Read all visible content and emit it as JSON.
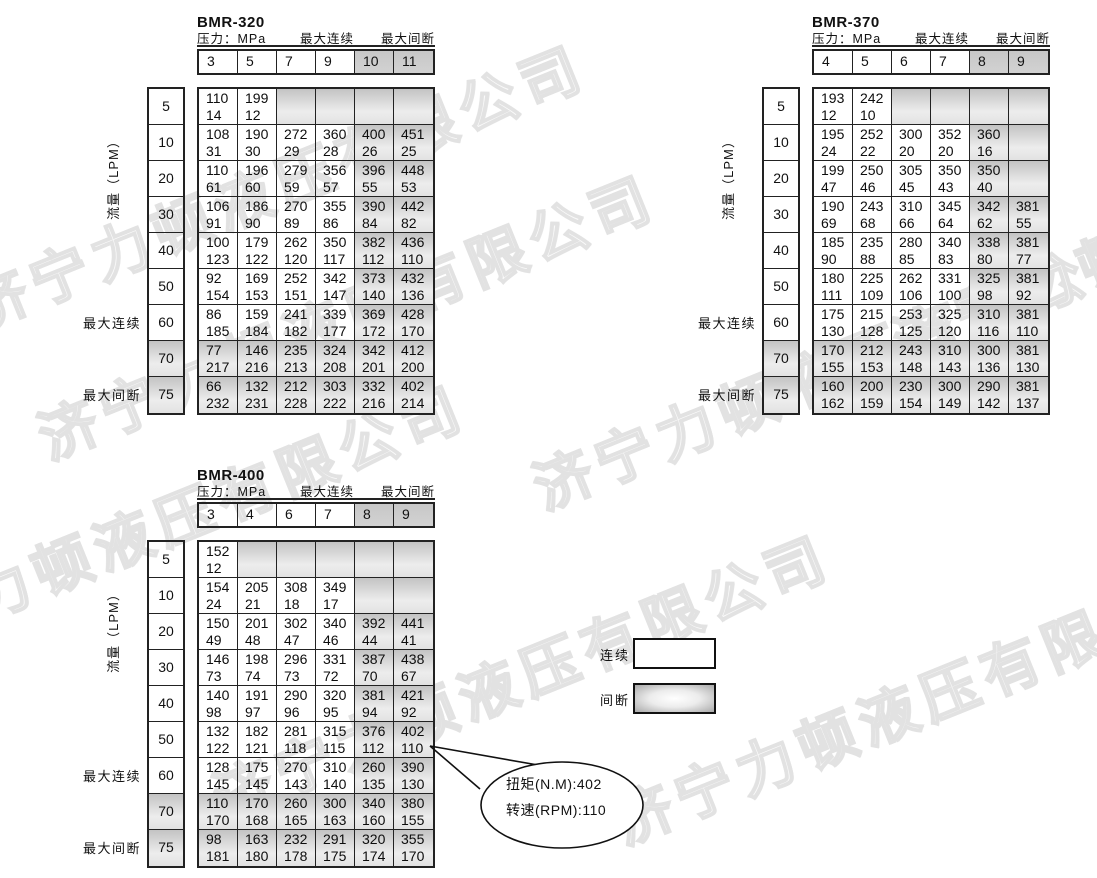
{
  "watermark": {
    "text": "济宁力顿液压有限公司"
  },
  "labels": {
    "pressure": "压力：MPa",
    "max_continuous": "最大连续",
    "max_intermittent": "最大间断",
    "flow": "流量（LPM）"
  },
  "legend": {
    "continuous": "连续",
    "intermittent": "间断"
  },
  "callout": {
    "line1": "扭矩(N.M):402",
    "line2": "转速(RPM):110"
  },
  "tables": [
    {
      "title": "BMR-320",
      "pressures": [
        "3",
        "5",
        "7",
        "9",
        "10",
        "11"
      ],
      "rows": [
        {
          "flow": "5",
          "cells": [
            [
              "110",
              "14"
            ],
            [
              "199",
              "12"
            ],
            null,
            null,
            null,
            null
          ]
        },
        {
          "flow": "10",
          "cells": [
            [
              "108",
              "31"
            ],
            [
              "190",
              "30"
            ],
            [
              "272",
              "29"
            ],
            [
              "360",
              "28"
            ],
            [
              "400",
              "26"
            ],
            [
              "451",
              "25"
            ]
          ]
        },
        {
          "flow": "20",
          "cells": [
            [
              "110",
              "61"
            ],
            [
              "196",
              "60"
            ],
            [
              "279",
              "59"
            ],
            [
              "356",
              "57"
            ],
            [
              "396",
              "55"
            ],
            [
              "448",
              "53"
            ]
          ]
        },
        {
          "flow": "30",
          "cells": [
            [
              "106",
              "91"
            ],
            [
              "186",
              "90"
            ],
            [
              "270",
              "89"
            ],
            [
              "355",
              "86"
            ],
            [
              "390",
              "84"
            ],
            [
              "442",
              "82"
            ]
          ]
        },
        {
          "flow": "40",
          "cells": [
            [
              "100",
              "123"
            ],
            [
              "179",
              "122"
            ],
            [
              "262",
              "120"
            ],
            [
              "350",
              "117"
            ],
            [
              "382",
              "112"
            ],
            [
              "436",
              "110"
            ]
          ]
        },
        {
          "flow": "50",
          "cells": [
            [
              "92",
              "154"
            ],
            [
              "169",
              "153"
            ],
            [
              "252",
              "151"
            ],
            [
              "342",
              "147"
            ],
            [
              "373",
              "140"
            ],
            [
              "432",
              "136"
            ]
          ]
        },
        {
          "flow": "60",
          "side": "max_continuous",
          "cells": [
            [
              "86",
              "185"
            ],
            [
              "159",
              "184"
            ],
            [
              "241",
              "182"
            ],
            [
              "339",
              "177"
            ],
            [
              "369",
              "172"
            ],
            [
              "428",
              "170"
            ]
          ]
        },
        {
          "flow": "70",
          "shaded": true,
          "cells": [
            [
              "77",
              "217"
            ],
            [
              "146",
              "216"
            ],
            [
              "235",
              "213"
            ],
            [
              "324",
              "208"
            ],
            [
              "342",
              "201"
            ],
            [
              "412",
              "200"
            ]
          ]
        },
        {
          "flow": "75",
          "side": "max_intermittent",
          "shaded": true,
          "cells": [
            [
              "66",
              "232"
            ],
            [
              "132",
              "231"
            ],
            [
              "212",
              "228"
            ],
            [
              "303",
              "222"
            ],
            [
              "332",
              "216"
            ],
            [
              "402",
              "214"
            ]
          ]
        }
      ]
    },
    {
      "title": "BMR-370",
      "pressures": [
        "4",
        "5",
        "6",
        "7",
        "8",
        "9"
      ],
      "rows": [
        {
          "flow": "5",
          "cells": [
            [
              "193",
              "12"
            ],
            [
              "242",
              "10"
            ],
            null,
            null,
            null,
            null
          ]
        },
        {
          "flow": "10",
          "cells": [
            [
              "195",
              "24"
            ],
            [
              "252",
              "22"
            ],
            [
              "300",
              "20"
            ],
            [
              "352",
              "20"
            ],
            [
              "360",
              "16"
            ],
            null
          ]
        },
        {
          "flow": "20",
          "cells": [
            [
              "199",
              "47"
            ],
            [
              "250",
              "46"
            ],
            [
              "305",
              "45"
            ],
            [
              "350",
              "43"
            ],
            [
              "350",
              "40"
            ],
            null
          ]
        },
        {
          "flow": "30",
          "cells": [
            [
              "190",
              "69"
            ],
            [
              "243",
              "68"
            ],
            [
              "310",
              "66"
            ],
            [
              "345",
              "64"
            ],
            [
              "342",
              "62"
            ],
            [
              "381",
              "55"
            ]
          ]
        },
        {
          "flow": "40",
          "cells": [
            [
              "185",
              "90"
            ],
            [
              "235",
              "88"
            ],
            [
              "280",
              "85"
            ],
            [
              "340",
              "83"
            ],
            [
              "338",
              "80"
            ],
            [
              "381",
              "77"
            ]
          ]
        },
        {
          "flow": "50",
          "cells": [
            [
              "180",
              "111"
            ],
            [
              "225",
              "109"
            ],
            [
              "262",
              "106"
            ],
            [
              "331",
              "100"
            ],
            [
              "325",
              "98"
            ],
            [
              "381",
              "92"
            ]
          ]
        },
        {
          "flow": "60",
          "side": "max_continuous",
          "cells": [
            [
              "175",
              "130"
            ],
            [
              "215",
              "128"
            ],
            [
              "253",
              "125"
            ],
            [
              "325",
              "120"
            ],
            [
              "310",
              "116"
            ],
            [
              "381",
              "110"
            ]
          ]
        },
        {
          "flow": "70",
          "shaded": true,
          "cells": [
            [
              "170",
              "155"
            ],
            [
              "212",
              "153"
            ],
            [
              "243",
              "148"
            ],
            [
              "310",
              "143"
            ],
            [
              "300",
              "136"
            ],
            [
              "381",
              "130"
            ]
          ]
        },
        {
          "flow": "75",
          "side": "max_intermittent",
          "shaded": true,
          "cells": [
            [
              "160",
              "162"
            ],
            [
              "200",
              "159"
            ],
            [
              "230",
              "154"
            ],
            [
              "300",
              "149"
            ],
            [
              "290",
              "142"
            ],
            [
              "381",
              "137"
            ]
          ]
        }
      ]
    },
    {
      "title": "BMR-400",
      "pressures": [
        "3",
        "4",
        "6",
        "7",
        "8",
        "9"
      ],
      "rows": [
        {
          "flow": "5",
          "cells": [
            [
              "152",
              "12"
            ],
            null,
            null,
            null,
            null,
            null
          ]
        },
        {
          "flow": "10",
          "cells": [
            [
              "154",
              "24"
            ],
            [
              "205",
              "21"
            ],
            [
              "308",
              "18"
            ],
            [
              "349",
              "17"
            ],
            null,
            null
          ]
        },
        {
          "flow": "20",
          "cells": [
            [
              "150",
              "49"
            ],
            [
              "201",
              "48"
            ],
            [
              "302",
              "47"
            ],
            [
              "340",
              "46"
            ],
            [
              "392",
              "44"
            ],
            [
              "441",
              "41"
            ]
          ]
        },
        {
          "flow": "30",
          "cells": [
            [
              "146",
              "73"
            ],
            [
              "198",
              "74"
            ],
            [
              "296",
              "73"
            ],
            [
              "331",
              "72"
            ],
            [
              "387",
              "70"
            ],
            [
              "438",
              "67"
            ]
          ]
        },
        {
          "flow": "40",
          "cells": [
            [
              "140",
              "98"
            ],
            [
              "191",
              "97"
            ],
            [
              "290",
              "96"
            ],
            [
              "320",
              "95"
            ],
            [
              "381",
              "94"
            ],
            [
              "421",
              "92"
            ]
          ]
        },
        {
          "flow": "50",
          "cells": [
            [
              "132",
              "122"
            ],
            [
              "182",
              "121"
            ],
            [
              "281",
              "118"
            ],
            [
              "315",
              "115"
            ],
            [
              "376",
              "112"
            ],
            [
              "402",
              "110"
            ]
          ]
        },
        {
          "flow": "60",
          "side": "max_continuous",
          "cells": [
            [
              "128",
              "145"
            ],
            [
              "175",
              "145"
            ],
            [
              "270",
              "143"
            ],
            [
              "310",
              "140"
            ],
            [
              "260",
              "135"
            ],
            [
              "390",
              "130"
            ]
          ]
        },
        {
          "flow": "70",
          "shaded": true,
          "cells": [
            [
              "110",
              "170"
            ],
            [
              "170",
              "168"
            ],
            [
              "260",
              "165"
            ],
            [
              "300",
              "163"
            ],
            [
              "340",
              "160"
            ],
            [
              "380",
              "155"
            ]
          ]
        },
        {
          "flow": "75",
          "side": "max_intermittent",
          "shaded": true,
          "cells": [
            [
              "98",
              "181"
            ],
            [
              "163",
              "180"
            ],
            [
              "232",
              "178"
            ],
            [
              "291",
              "175"
            ],
            [
              "320",
              "174"
            ],
            [
              "355",
              "170"
            ]
          ]
        }
      ]
    }
  ],
  "colors": {
    "border": "#222222",
    "shaded_dark": "#c3c3c3",
    "shaded_light": "#ededed"
  }
}
